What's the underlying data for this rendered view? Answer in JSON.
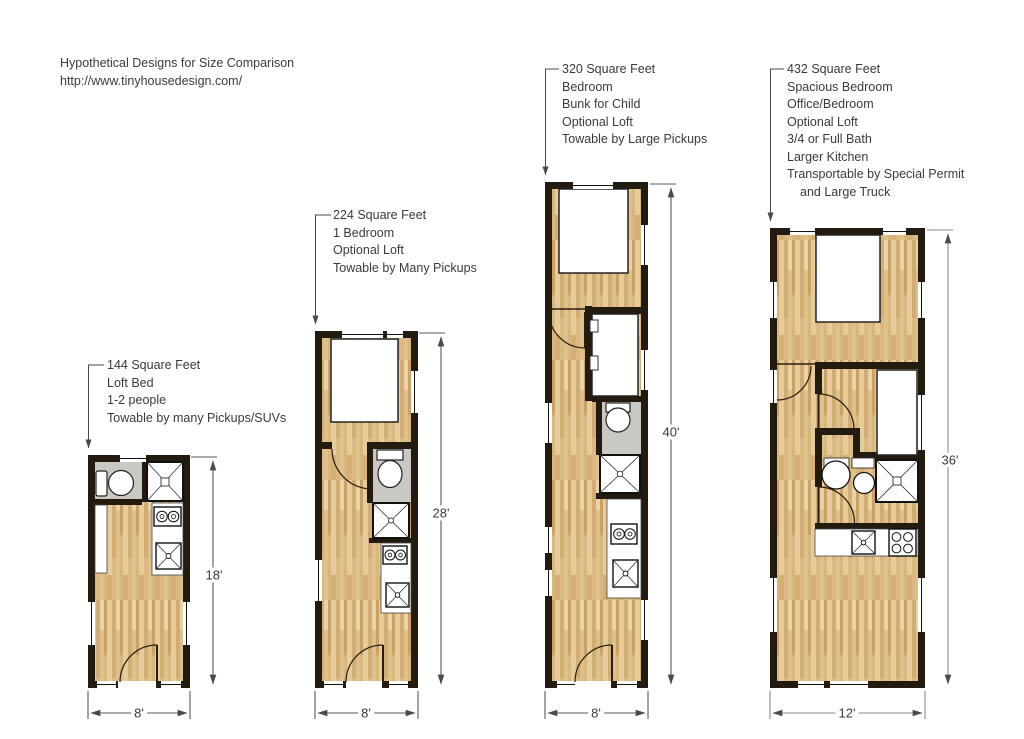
{
  "header": {
    "title": "Hypothetical Designs for Size Comparison",
    "url": "http://www.tinyhousedesign.com/"
  },
  "palette": {
    "wall": "#231a10",
    "wood_base": "#e2c492",
    "bath_floor": "#c9c8c3",
    "dimension_line": "#5a5a5a",
    "text": "#3b3b3b"
  },
  "plans": [
    {
      "name": "144-square-feet",
      "features": [
        "144 Square Feet",
        "Loft Bed",
        "1-2 people",
        "Towable by many Pickups/SUVs"
      ],
      "length_label": "18'",
      "width_label": "8'"
    },
    {
      "name": "224-square-feet",
      "features": [
        "224 Square Feet",
        "1 Bedroom",
        "Optional Loft",
        "Towable by Many Pickups"
      ],
      "length_label": "28'",
      "width_label": "8'"
    },
    {
      "name": "320-square-feet",
      "features": [
        "320 Square Feet",
        "Bedroom",
        "Bunk for Child",
        "Optional Loft",
        "Towable by Large Pickups"
      ],
      "length_label": "40'",
      "width_label": "8'"
    },
    {
      "name": "432-square-feet",
      "features": [
        "432 Square Feet",
        "Spacious Bedroom",
        "Office/Bedroom",
        "Optional Loft",
        "3/4 or Full Bath",
        "Larger Kitchen",
        "Transportable by Special Permit",
        "and Large Truck"
      ],
      "length_label": "36'",
      "width_label": "12'"
    }
  ]
}
